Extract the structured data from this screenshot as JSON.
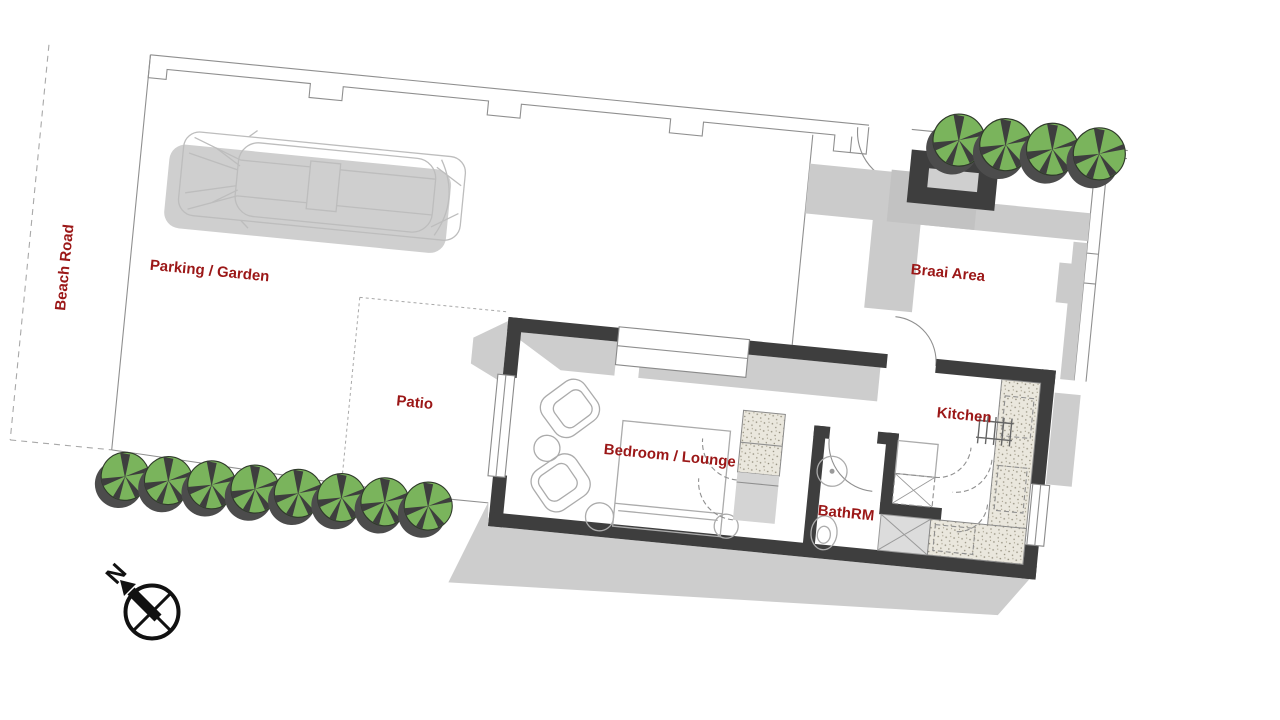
{
  "labels": {
    "beach_road": "Beach Road",
    "parking": "Parking / Garden",
    "patio": "Patio",
    "bedroom": "Bedroom / Lounge",
    "bathroom": "BathRM",
    "kitchen": "Kitchen",
    "braai": "Braai Area",
    "north": "N"
  },
  "colors": {
    "label_red": "#9b1717",
    "wall_dark": "#3e3e3e",
    "shadow_grey": "#cdcdcd",
    "tree_green": "#7ab45c",
    "tree_shadow": "#4c4c4c",
    "counter_beige": "#eae7dd",
    "compass_black": "#111111"
  },
  "site": {
    "plan_rotation_deg": 5.6,
    "tree_rows": [
      {
        "target": "trees-bottom-row",
        "count": 8,
        "x0": 139,
        "dx": 43.5,
        "y": 526,
        "r": 24
      },
      {
        "target": "trees-top-row",
        "count": 4,
        "x0": 936,
        "dx": 47,
        "y": 110,
        "r": 26
      }
    ]
  }
}
